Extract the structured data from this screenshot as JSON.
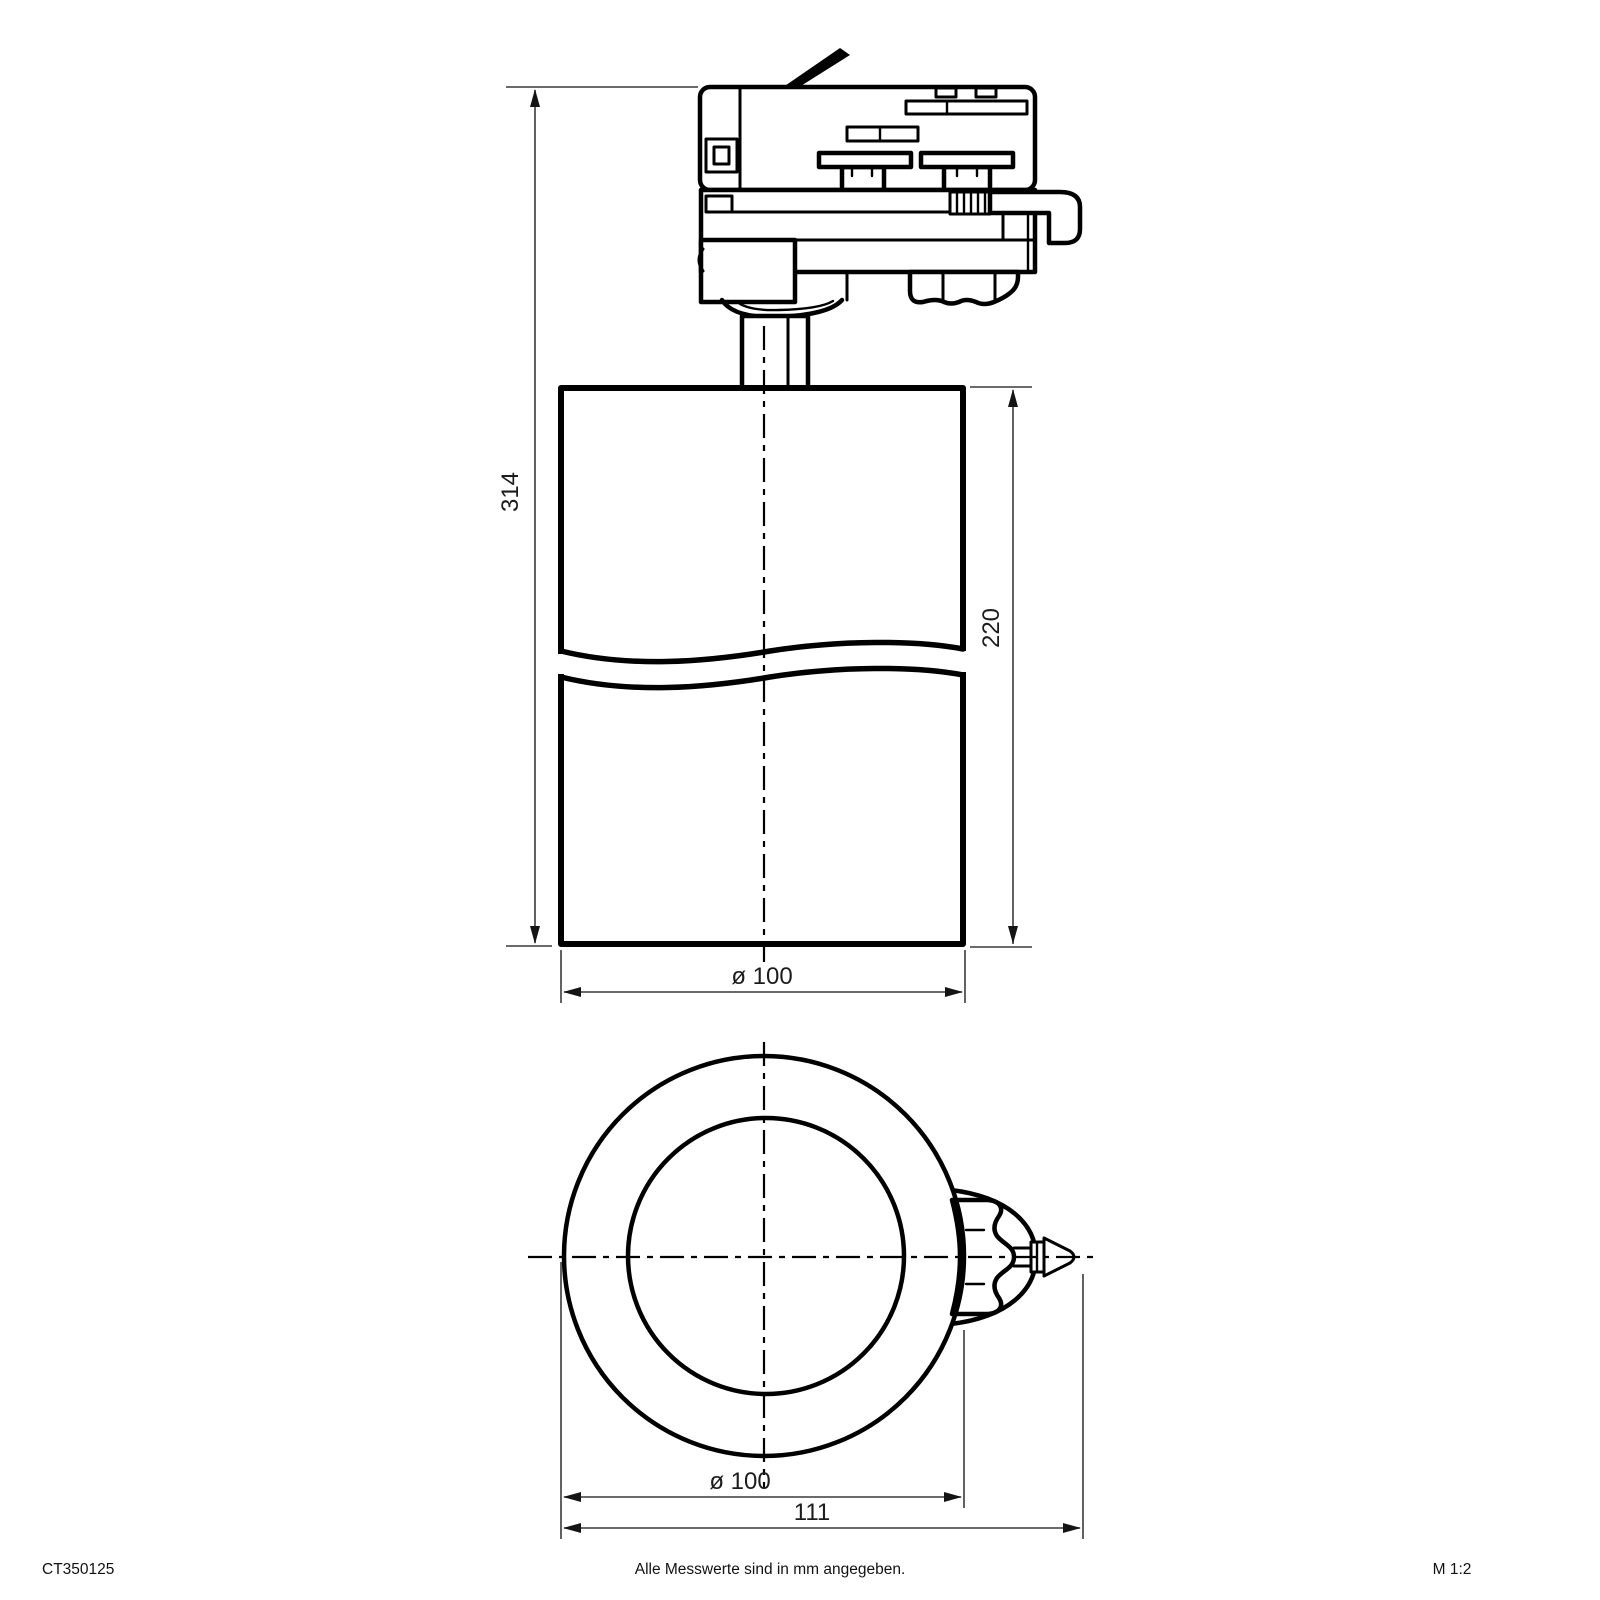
{
  "drawing": {
    "product_code": "CT350125",
    "note": "Alle Messwerte sind in mm angegeben.",
    "scale_label": "M 1:2",
    "colors": {
      "line": "#000000",
      "dimension": "#3a3a3a",
      "background": "#ffffff"
    },
    "dimensions": {
      "total_height_mm": "314",
      "body_height_mm": "220",
      "body_diameter_side_mm": "ø 100",
      "body_diameter_front_mm": "ø 100",
      "overall_width_mm": "111"
    },
    "views": {
      "side_view": "track spotlight side elevation with 3-phase track adapter",
      "front_view": "front view of cylindrical body with locking knob"
    }
  }
}
